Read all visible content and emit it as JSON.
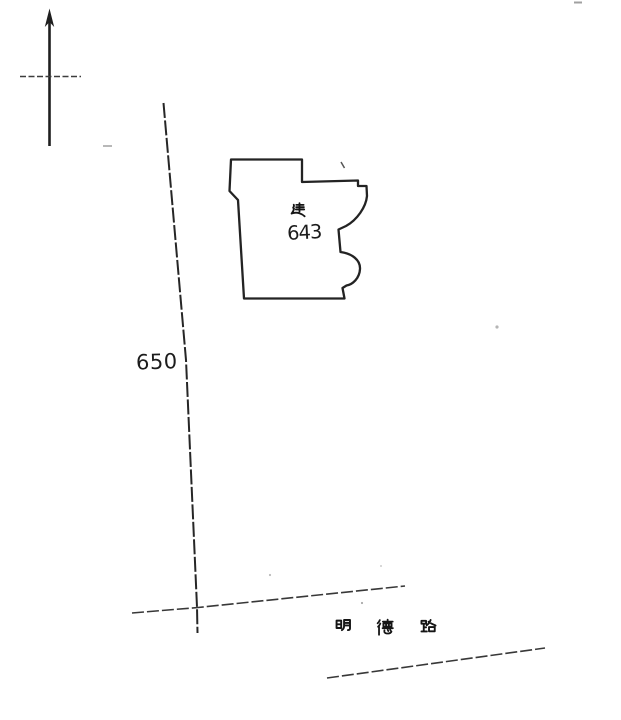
{
  "document": {
    "kind": "scanned cadastral sketch map",
    "background_color": "#ffffff",
    "ink_color": "#232323"
  },
  "north_arrow": {
    "icon": "north-arrow"
  },
  "boundary": {
    "parcel_number": "650"
  },
  "building": {
    "marker": "建",
    "number": "643"
  },
  "road": {
    "name": "明德路",
    "chars": [
      "明",
      "德",
      "路"
    ]
  }
}
